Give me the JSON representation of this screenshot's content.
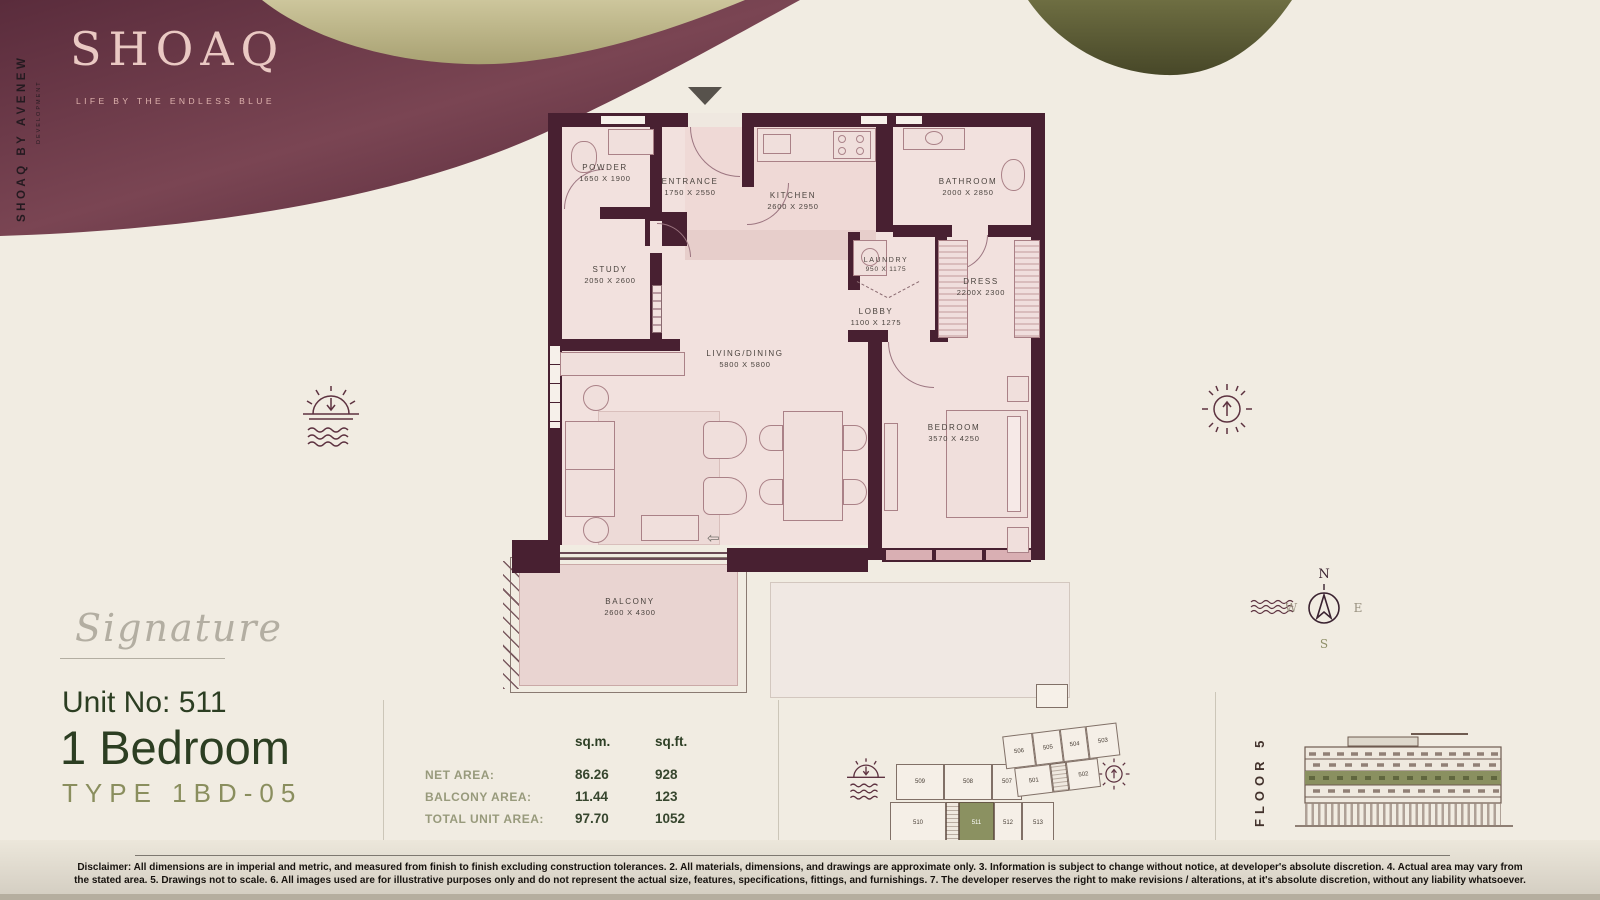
{
  "brand": {
    "logo": "SHOAQ",
    "tagline": "LIFE BY THE ENDLESS BLUE",
    "side_text": "SHOAQ BY ĀVENEW",
    "side_sub": "DEVELOPMENT"
  },
  "rooms": [
    {
      "name": "POWDER",
      "dims": "1650 X 1900"
    },
    {
      "name": "ENTRANCE",
      "dims": "1750 X 2550"
    },
    {
      "name": "KITCHEN",
      "dims": "2600 X 2950"
    },
    {
      "name": "BATHROOM",
      "dims": "2000 X 2850"
    },
    {
      "name": "STUDY",
      "dims": "2050 X 2600"
    },
    {
      "name": "LAUNDRY",
      "dims": "950 X 1175"
    },
    {
      "name": "DRESS",
      "dims": "2200X 2300"
    },
    {
      "name": "LOBBY",
      "dims": "1100 X 1275"
    },
    {
      "name": "LIVING/DINING",
      "dims": "5800 X 5800"
    },
    {
      "name": "BEDROOM",
      "dims": "3570 X 4250"
    },
    {
      "name": "BALCONY",
      "dims": "2600 X 4300"
    }
  ],
  "plan": {
    "exit_arrow": "⇦"
  },
  "unit": {
    "collection": "Signature",
    "unit_no": "Unit No: 511",
    "bedrooms": "1 Bedroom",
    "type": "TYPE 1BD-05"
  },
  "areas": {
    "col_sqm": "sq.m.",
    "col_sqft": "sq.ft.",
    "rows": [
      {
        "label": "NET AREA:",
        "sqm": "86.26",
        "sqft": "928"
      },
      {
        "label": "BALCONY AREA:",
        "sqm": "11.44",
        "sqft": "123"
      },
      {
        "label": "TOTAL UNIT AREA:",
        "sqm": "97.70",
        "sqft": "1052"
      }
    ]
  },
  "keyplan": {
    "left_top": [
      "509",
      "508",
      "507"
    ],
    "left_bottom": [
      "510",
      "511",
      "512",
      "513"
    ],
    "right_top": [
      "506",
      "505",
      "504",
      "503"
    ],
    "right_bottom": [
      "501",
      "502"
    ],
    "highlighted_unit": "511"
  },
  "floor": {
    "label": "FLOOR 5"
  },
  "compass": {
    "n": "N",
    "e": "E",
    "s": "S",
    "w": "W"
  },
  "disclaimer": "Disclaimer: All dimensions are in imperial and metric, and measured from finish to finish excluding construction tolerances. 2. All materials, dimensions, and drawings are approximate only. 3. Information is subject to change without notice, at developer's absolute discretion. 4. Actual area may vary from the stated area. 5. Drawings not to scale. 6. All images used are for illustrative purposes only and do not represent the actual size, features, specifications, fittings, and furnishings. 7. The developer reserves the right to make revisions / alterations, at it's absolute discretion, without any liability whatsoever.",
  "colors": {
    "wall": "#482031",
    "maroon": "#6d3b4a",
    "khaki": "#c4bd92",
    "olive": "#8b9161",
    "dark_green": "#2c3e22",
    "cream": "#f1ece2"
  }
}
